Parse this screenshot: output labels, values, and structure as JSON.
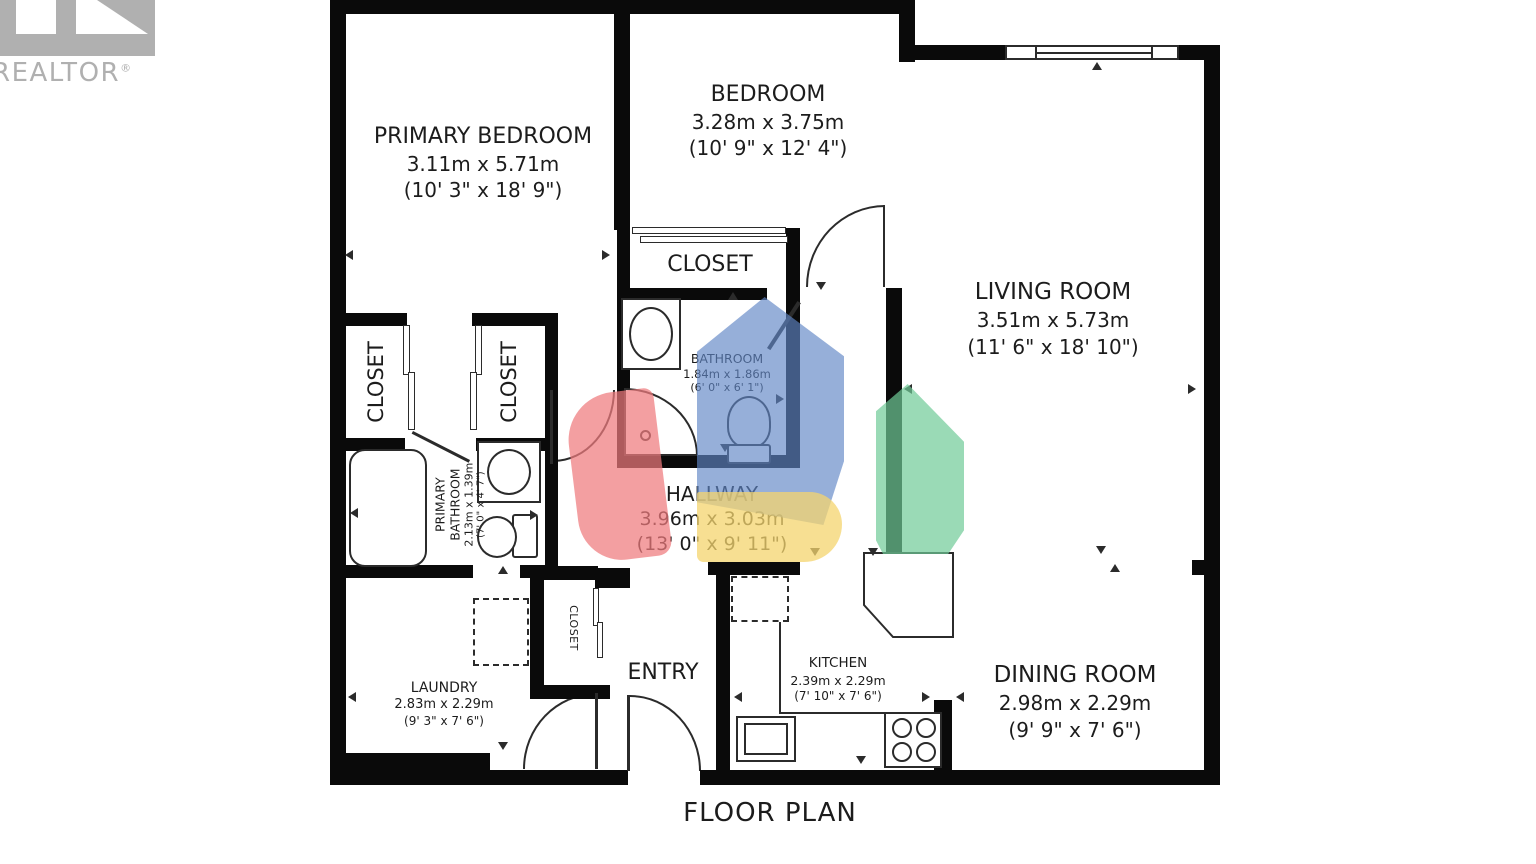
{
  "branding": {
    "name": "REALTOR",
    "reg": "®"
  },
  "plan_title": "FLOOR PLAN",
  "labels": {
    "closet": "CLOSET"
  },
  "rooms": {
    "primary_bedroom": {
      "name": "PRIMARY BEDROOM",
      "metric": "3.11m x 5.71m",
      "imperial": "(10' 3\" x 18' 9\")"
    },
    "bedroom": {
      "name": "BEDROOM",
      "metric": "3.28m x 3.75m",
      "imperial": "(10' 9\" x 12' 4\")"
    },
    "living_room": {
      "name": "LIVING ROOM",
      "metric": "3.51m x 5.73m",
      "imperial": "(11' 6\" x 18' 10\")"
    },
    "bathroom": {
      "name": "BATHROOM",
      "metric": "1.84m x 1.86m",
      "imperial": "(6' 0\" x 6' 1\")"
    },
    "hallway": {
      "name": "HALLWAY",
      "metric": "3.96m x 3.03m",
      "imperial": "(13' 0\" x 9' 11\")"
    },
    "primary_bathroom": {
      "name": "PRIMARY BATHROOM",
      "metric": "2.13m x 1.39m",
      "imperial": "(7' 0\" x 4' 7\")"
    },
    "laundry": {
      "name": "LAUNDRY",
      "metric": "2.83m x 2.29m",
      "imperial": "(9' 3\" x 7' 6\")"
    },
    "entry": {
      "name": "ENTRY"
    },
    "kitchen": {
      "name": "KITCHEN",
      "metric": "2.39m x 2.29m",
      "imperial": "(7' 10\" x 7' 6\")"
    },
    "dining_room": {
      "name": "DINING ROOM",
      "metric": "2.98m x 2.29m",
      "imperial": "(9' 9\" x 7' 6\")"
    }
  },
  "colors": {
    "wall": "#0a0a0a",
    "line": "#2b2b2b",
    "text": "#1c1c1c",
    "logo": "#b0b0b0",
    "wm_blue": "#5f86c6",
    "wm_red": "#ee7a7d",
    "wm_yellow": "#f4d46d",
    "wm_green": "#6fcb97"
  }
}
